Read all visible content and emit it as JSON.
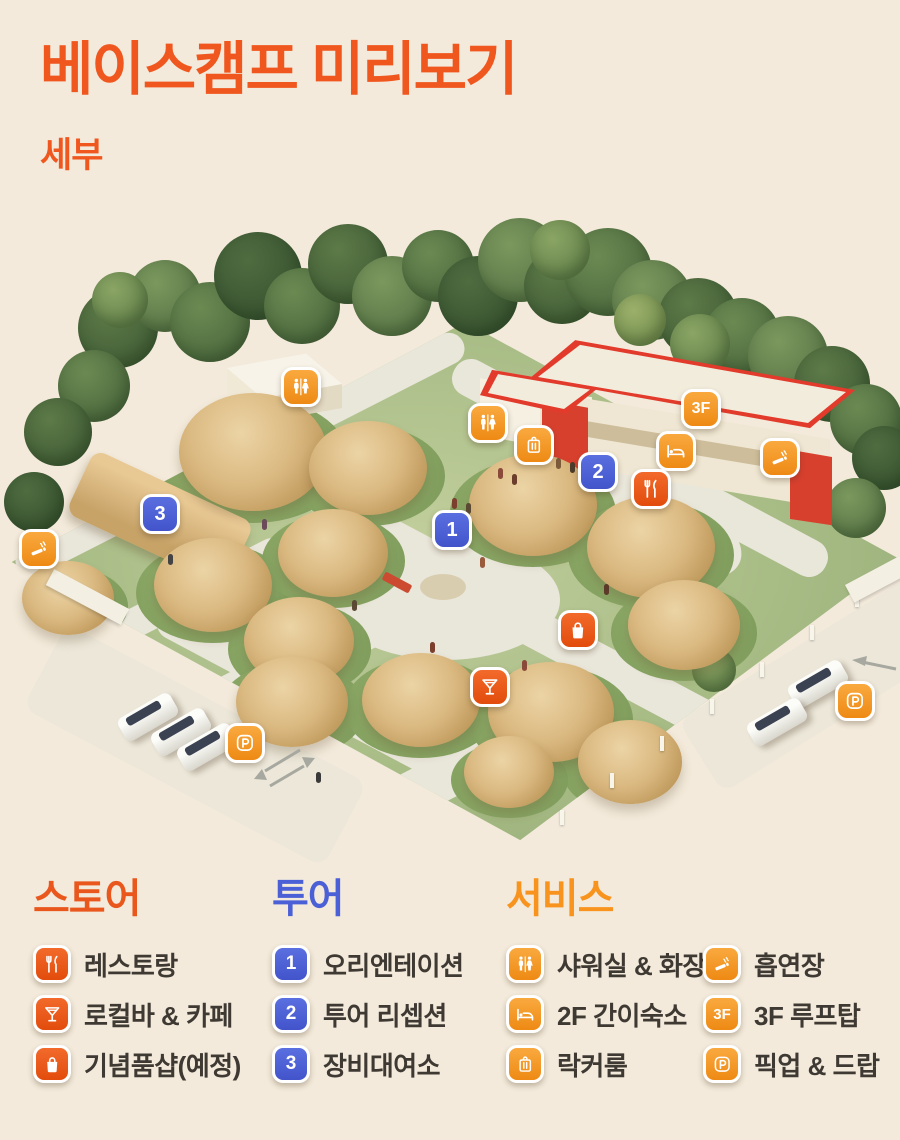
{
  "page": {
    "title": "베이스캠프 미리보기",
    "subtitle": "세부"
  },
  "colors": {
    "background": "#F3EADB",
    "title_orange": "#F0571E",
    "deep_orange_chip": "#E8500F",
    "light_orange_chip": "#F49A2B",
    "blue_badge": "#4B60D6",
    "label_text": "#3E3933"
  },
  "map": {
    "markers": [
      {
        "name": "shower-toilet-1",
        "icon": "restroom-icon",
        "style": "light",
        "x": 301,
        "y": 387
      },
      {
        "name": "shower-toilet-2",
        "icon": "restroom-icon",
        "style": "light",
        "x": 488,
        "y": 423
      },
      {
        "name": "locker-room",
        "icon": "locker-icon",
        "style": "light",
        "x": 534,
        "y": 445
      },
      {
        "name": "rooftop-3f",
        "text": "3F",
        "style": "light",
        "x": 701,
        "y": 409
      },
      {
        "name": "hostel-2f",
        "icon": "bed-icon",
        "style": "light",
        "x": 676,
        "y": 451
      },
      {
        "name": "tour-reception",
        "text": "2",
        "style": "blue",
        "x": 598,
        "y": 472
      },
      {
        "name": "restaurant",
        "icon": "restaurant-icon",
        "style": "deep",
        "x": 651,
        "y": 489
      },
      {
        "name": "smoking-area-east",
        "icon": "smoking-icon",
        "style": "light",
        "x": 780,
        "y": 458
      },
      {
        "name": "equipment-rental",
        "text": "3",
        "style": "blue",
        "x": 160,
        "y": 514
      },
      {
        "name": "smoking-area-west",
        "icon": "smoking-icon",
        "style": "light",
        "x": 39,
        "y": 549
      },
      {
        "name": "orientation",
        "text": "1",
        "style": "blue",
        "x": 452,
        "y": 530
      },
      {
        "name": "souvenir-shop",
        "icon": "bag-icon",
        "style": "deep",
        "x": 578,
        "y": 630
      },
      {
        "name": "local-bar-cafe",
        "icon": "cocktail-icon",
        "style": "deep",
        "x": 490,
        "y": 687
      },
      {
        "name": "pickup-drop-east",
        "icon": "parking-icon",
        "style": "light",
        "x": 855,
        "y": 701
      },
      {
        "name": "pickup-drop-west",
        "icon": "parking-icon",
        "style": "light",
        "x": 245,
        "y": 743
      }
    ]
  },
  "legend": {
    "store": {
      "heading": "스토어",
      "items": [
        {
          "icon": "restaurant-icon",
          "style": "deep",
          "label": "레스토랑"
        },
        {
          "icon": "cocktail-icon",
          "style": "deep",
          "label": "로컬바 & 카페"
        },
        {
          "icon": "bag-icon",
          "style": "deep",
          "label": "기념품샵(예정)"
        }
      ]
    },
    "tour": {
      "heading": "투어",
      "items": [
        {
          "text": "1",
          "style": "blue",
          "label": "오리엔테이션"
        },
        {
          "text": "2",
          "style": "blue",
          "label": "투어 리셉션"
        },
        {
          "text": "3",
          "style": "blue",
          "label": "장비대여소"
        }
      ]
    },
    "service": {
      "heading": "서비스",
      "items": [
        {
          "icon": "restroom-icon",
          "style": "light",
          "label": "샤워실 & 화장실"
        },
        {
          "icon": "bed-icon",
          "style": "light",
          "label": "2F 간이숙소"
        },
        {
          "icon": "locker-icon",
          "style": "light",
          "label": "락커룸"
        },
        {
          "icon": "smoking-icon",
          "style": "light",
          "label": "흡연장"
        },
        {
          "text": "3F",
          "style": "light",
          "label": "3F 루프탑"
        },
        {
          "icon": "parking-icon",
          "style": "light",
          "label": "픽업 & 드랍"
        }
      ]
    }
  }
}
